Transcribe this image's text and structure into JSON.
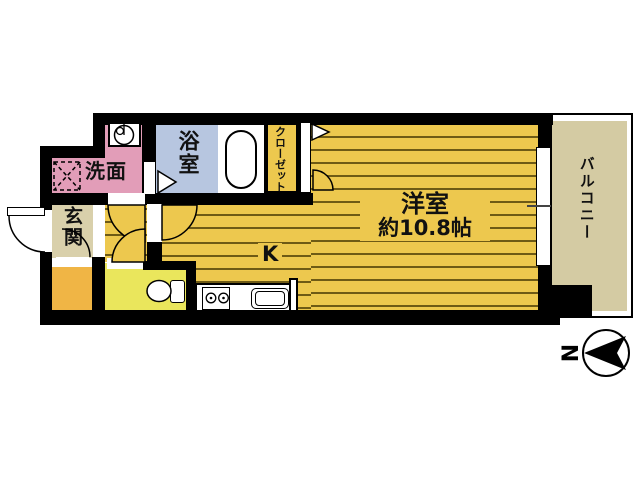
{
  "plan": {
    "rooms": {
      "washroom": "洗面",
      "bathroom": "浴室",
      "closet": "クローゼット",
      "entrance": "玄関",
      "kitchen": "K",
      "western_room_name": "洋室",
      "western_room_size": "約10.8帖",
      "balcony": "バルコニー"
    },
    "compass": {
      "label": "N"
    }
  },
  "colors": {
    "wall": "#000000",
    "gold": "#edc84e",
    "stripe": "#6e5a15",
    "pink": "#e29db8",
    "blue": "#b7c6e0",
    "beige": "#d9d0ab",
    "balconyfloor": "#d4cba3",
    "toilet": "#eae65c",
    "orange": "#f0b545"
  }
}
